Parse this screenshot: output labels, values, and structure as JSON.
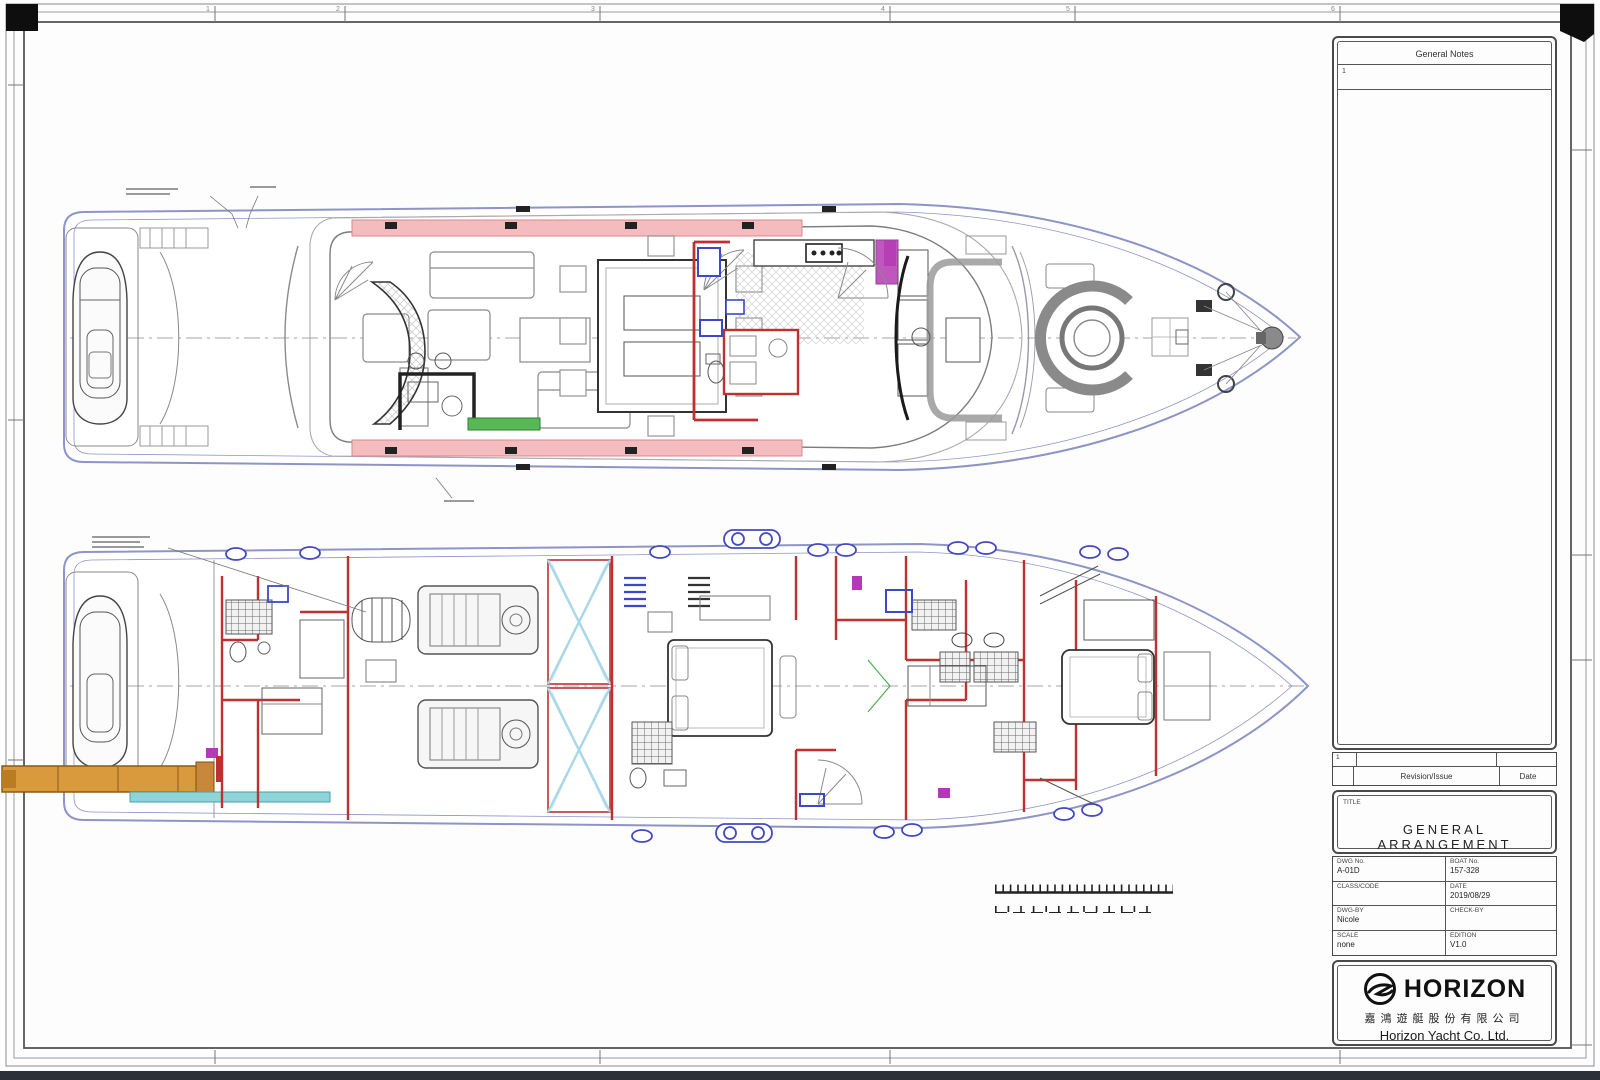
{
  "border": {
    "grid_numbers": [
      "1",
      "2",
      "3",
      "4",
      "5",
      "6"
    ]
  },
  "notes_panel": {
    "header": "General Notes",
    "rows": [
      "1"
    ]
  },
  "revision_table": {
    "row_number": "1",
    "columns": [
      "Revision/Issue",
      "Date"
    ]
  },
  "titleblock": {
    "title_label": "TITLE",
    "title": "GENERAL  ARRANGEMENT",
    "fields": [
      {
        "label": "DWG  No.",
        "value": "A-01D"
      },
      {
        "label": "BOAT  No.",
        "value": "157-328"
      },
      {
        "label": "CLASS/CODE",
        "value": ""
      },
      {
        "label": "DATE",
        "value": "2019/08/29"
      },
      {
        "label": "DWG-BY",
        "value": "Nicole"
      },
      {
        "label": "CHECK-BY",
        "value": ""
      },
      {
        "label": "SCALE",
        "value": "none"
      },
      {
        "label": "EDITION",
        "value": "V1.0"
      }
    ]
  },
  "logo": {
    "brand": "HORIZON",
    "chinese": "嘉鴻遊艇股份有限公司",
    "company": "Horizon Yacht Co. Ltd."
  },
  "drawing": {
    "decks": [
      {
        "name": "main deck plan"
      },
      {
        "name": "lower deck plan"
      }
    ],
    "colors": {
      "hull_outline": "#8d94c8",
      "interior_walls": "#c03030",
      "side_deck": "#f4bcbe",
      "passerelle": "#d99a3d",
      "tender_platform_strip": "#8fd4d8",
      "sideboard_green": "#58b858",
      "fixtures_blue": "#3b49c8",
      "accent_magenta": "#b43ab4",
      "tank_crossbrace": "#a9d7e8"
    }
  }
}
